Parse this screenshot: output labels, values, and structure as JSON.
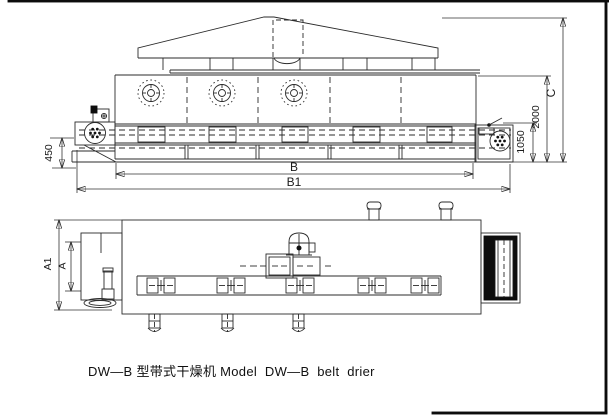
{
  "caption": "DW—B 型带式干燥机 Model  DW—B  belt  drier",
  "side_view": {
    "dim_450": "450",
    "dim_B": "B",
    "dim_B1": "B1",
    "dim_1050": "1050",
    "dim_2000": "2000",
    "dim_C": "C"
  },
  "plan_view": {
    "dim_A1": "A1",
    "dim_A": "A"
  },
  "colors": {
    "line": "#2b2b2b",
    "background": "#ffffff",
    "solid_fill": "#0d0d0d"
  }
}
